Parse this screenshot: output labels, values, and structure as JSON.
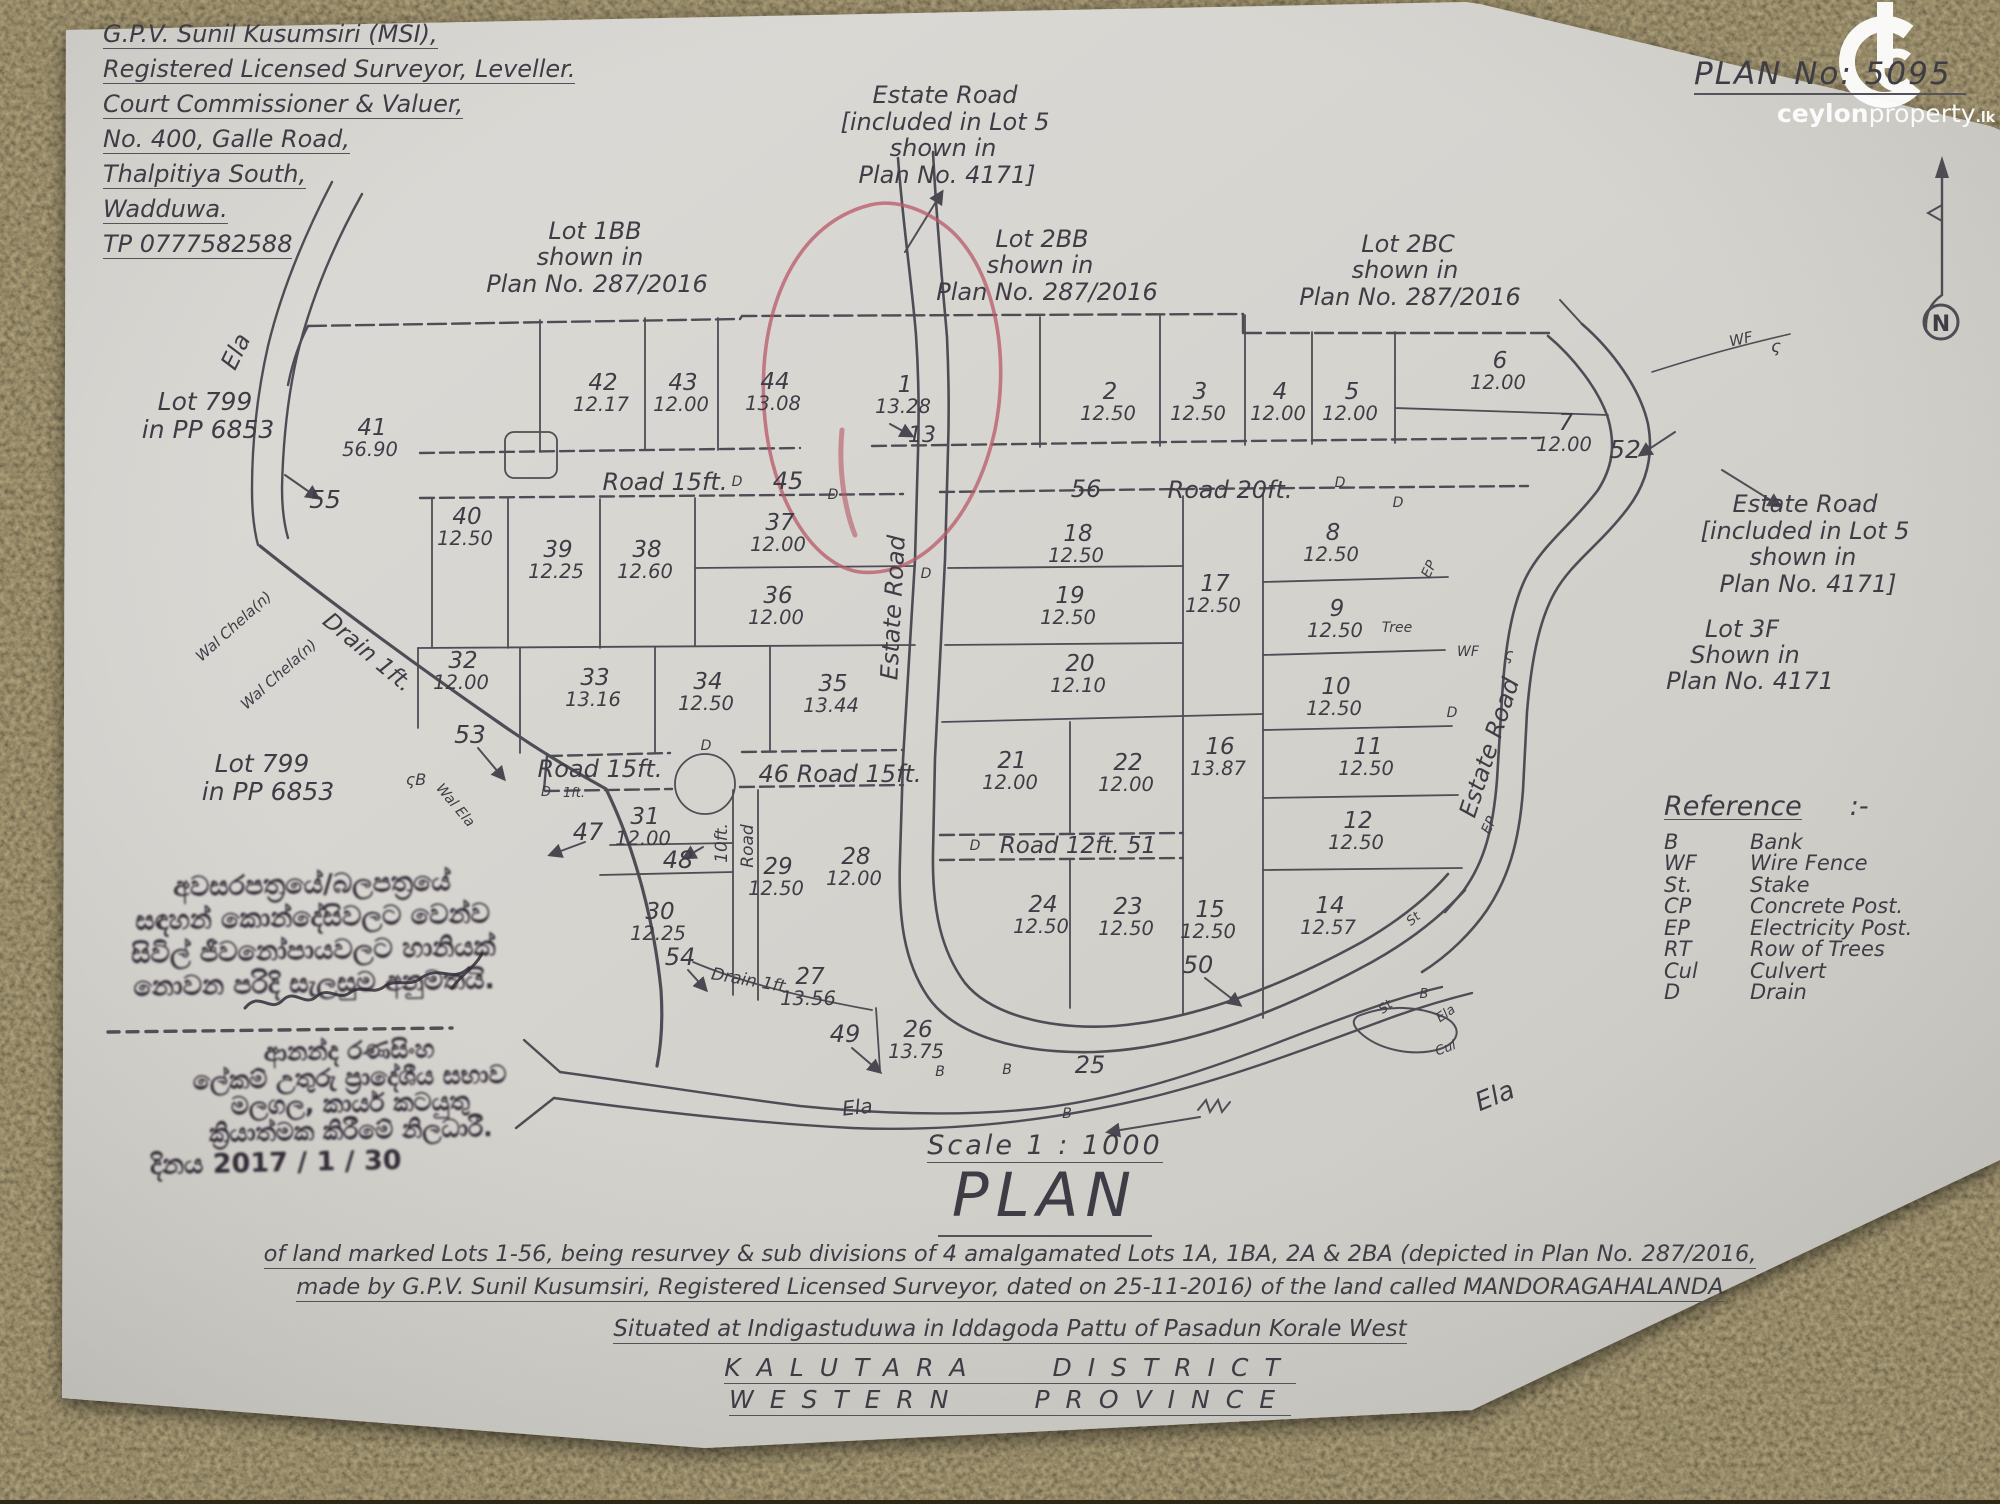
{
  "watermark": {
    "brand_main": "ceylon",
    "brand_sub": "property",
    "brand_tld": ".lk"
  },
  "plan_no": "PLAN No: 5095",
  "north_label": "N",
  "surveyor": {
    "lines": [
      "G.P.V. Sunil Kusumsiri (MSI),",
      "Registered Licensed Surveyor, Leveller.",
      "Court Commissioner & Valuer,",
      "No. 400, Galle Road,",
      "Thalpitiya South,",
      "Wadduwa.",
      "TP 0777582588"
    ]
  },
  "map": {
    "lots": [
      {
        "n": "41",
        "a": "56.90",
        "x": 372,
        "y": 435
      },
      {
        "n": "42",
        "a": "12.17",
        "x": 603,
        "y": 390
      },
      {
        "n": "43",
        "a": "12.00",
        "x": 683,
        "y": 390
      },
      {
        "n": "44",
        "a": "13.08",
        "x": 775,
        "y": 389
      },
      {
        "n": "1",
        "a": "13.28",
        "x": 905,
        "y": 392
      },
      {
        "n": "2",
        "a": "12.50",
        "x": 1110,
        "y": 399
      },
      {
        "n": "3",
        "a": "12.50",
        "x": 1200,
        "y": 399
      },
      {
        "n": "4",
        "a": "12.00",
        "x": 1280,
        "y": 399
      },
      {
        "n": "5",
        "a": "12.00",
        "x": 1352,
        "y": 399
      },
      {
        "n": "6",
        "a": "12.00",
        "x": 1500,
        "y": 368
      },
      {
        "n": "7",
        "a": "12.00",
        "x": 1566,
        "y": 430
      },
      {
        "n": "8",
        "a": "12.50",
        "x": 1333,
        "y": 540
      },
      {
        "n": "9",
        "a": "12.50",
        "x": 1337,
        "y": 616
      },
      {
        "n": "10",
        "a": "12.50",
        "x": 1336,
        "y": 694
      },
      {
        "n": "11",
        "a": "12.50",
        "x": 1368,
        "y": 754
      },
      {
        "n": "12",
        "a": "12.50",
        "x": 1358,
        "y": 828
      },
      {
        "n": "14",
        "a": "12.57",
        "x": 1330,
        "y": 913
      },
      {
        "n": "15",
        "a": "12.50",
        "x": 1210,
        "y": 917
      },
      {
        "n": "16",
        "a": "13.87",
        "x": 1220,
        "y": 754
      },
      {
        "n": "17",
        "a": "12.50",
        "x": 1215,
        "y": 591
      },
      {
        "n": "18",
        "a": "12.50",
        "x": 1078,
        "y": 541
      },
      {
        "n": "19",
        "a": "12.50",
        "x": 1070,
        "y": 603
      },
      {
        "n": "20",
        "a": "12.10",
        "x": 1080,
        "y": 671
      },
      {
        "n": "21",
        "a": "12.00",
        "x": 1012,
        "y": 768
      },
      {
        "n": "22",
        "a": "12.00",
        "x": 1128,
        "y": 770
      },
      {
        "n": "23",
        "a": "12.50",
        "x": 1128,
        "y": 914
      },
      {
        "n": "24",
        "a": "12.50",
        "x": 1043,
        "y": 912
      },
      {
        "n": "26",
        "a": "13.75",
        "x": 918,
        "y": 1037
      },
      {
        "n": "27",
        "a": "13.56",
        "x": 810,
        "y": 984
      },
      {
        "n": "28",
        "a": "12.00",
        "x": 856,
        "y": 864
      },
      {
        "n": "29",
        "a": "12.50",
        "x": 778,
        "y": 874
      },
      {
        "n": "30",
        "a": "12.25",
        "x": 660,
        "y": 919
      },
      {
        "n": "31",
        "a": "12.00",
        "x": 645,
        "y": 824
      },
      {
        "n": "32",
        "a": "12.00",
        "x": 463,
        "y": 668
      },
      {
        "n": "33",
        "a": "13.16",
        "x": 595,
        "y": 685
      },
      {
        "n": "34",
        "a": "12.50",
        "x": 708,
        "y": 689
      },
      {
        "n": "35",
        "a": "13.44",
        "x": 833,
        "y": 691
      },
      {
        "n": "36",
        "a": "12.00",
        "x": 778,
        "y": 603
      },
      {
        "n": "37",
        "a": "12.00",
        "x": 780,
        "y": 530
      },
      {
        "n": "38",
        "a": "12.60",
        "x": 647,
        "y": 557
      },
      {
        "n": "39",
        "a": "12.25",
        "x": 558,
        "y": 557
      },
      {
        "n": "40",
        "a": "12.50",
        "x": 467,
        "y": 524
      }
    ],
    "labels": [
      {
        "t": "Estate Road",
        "x": 945,
        "y": 103,
        "s": 24
      },
      {
        "t": "[included in Lot 5",
        "x": 945,
        "y": 130,
        "s": 24
      },
      {
        "t": "shown in",
        "x": 943,
        "y": 156,
        "s": 24
      },
      {
        "t": "Plan No. 4171]",
        "x": 947,
        "y": 183,
        "s": 24
      },
      {
        "t": "Lot 1BB",
        "x": 595,
        "y": 239,
        "s": 24
      },
      {
        "t": "shown in",
        "x": 590,
        "y": 265,
        "s": 24
      },
      {
        "t": "Plan No. 287/2016",
        "x": 597,
        "y": 292,
        "s": 24
      },
      {
        "t": "Lot 2BB",
        "x": 1042,
        "y": 247,
        "s": 24
      },
      {
        "t": "shown in",
        "x": 1040,
        "y": 273,
        "s": 24
      },
      {
        "t": "Plan No. 287/2016",
        "x": 1047,
        "y": 300,
        "s": 24
      },
      {
        "t": "Lot 2BC",
        "x": 1408,
        "y": 252,
        "s": 24
      },
      {
        "t": "shown in",
        "x": 1405,
        "y": 278,
        "s": 24
      },
      {
        "t": "Plan No. 287/2016",
        "x": 1410,
        "y": 305,
        "s": 24
      },
      {
        "t": "Lot 799",
        "x": 205,
        "y": 410,
        "s": 25
      },
      {
        "t": "in PP 6853",
        "x": 208,
        "y": 438,
        "s": 25
      },
      {
        "t": "Lot 799",
        "x": 262,
        "y": 772,
        "s": 25
      },
      {
        "t": "in PP 6853",
        "x": 268,
        "y": 800,
        "s": 25
      },
      {
        "t": "Estate Road",
        "x": 1805,
        "y": 512,
        "s": 24
      },
      {
        "t": "[included in Lot 5",
        "x": 1805,
        "y": 539,
        "s": 24
      },
      {
        "t": "shown in",
        "x": 1803,
        "y": 565,
        "s": 24
      },
      {
        "t": "Plan No. 4171]",
        "x": 1808,
        "y": 592,
        "s": 24
      },
      {
        "t": "Lot 3F",
        "x": 1742,
        "y": 637,
        "s": 24
      },
      {
        "t": "Shown in",
        "x": 1745,
        "y": 663,
        "s": 24
      },
      {
        "t": "Plan No. 4171",
        "x": 1750,
        "y": 689,
        "s": 24
      },
      {
        "t": "Road 15ft.",
        "x": 665,
        "y": 490,
        "s": 24
      },
      {
        "t": "45",
        "x": 788,
        "y": 489,
        "s": 24
      },
      {
        "t": "56",
        "x": 1086,
        "y": 497,
        "s": 24
      },
      {
        "t": "Road 20ft.",
        "x": 1230,
        "y": 498,
        "s": 24
      },
      {
        "t": "Road 15ft.",
        "x": 600,
        "y": 777,
        "s": 24
      },
      {
        "t": "46 Road 15ft.",
        "x": 840,
        "y": 782,
        "s": 24
      },
      {
        "t": "Road 12ft. 51",
        "x": 1078,
        "y": 853,
        "s": 23
      },
      {
        "t": "10ft.",
        "x": 727,
        "y": 843,
        "s": 17,
        "r": -90
      },
      {
        "t": "Road",
        "x": 753,
        "y": 846,
        "s": 17,
        "r": -90
      },
      {
        "t": "Estate Road",
        "x": 901,
        "y": 608,
        "s": 24,
        "r": -87
      },
      {
        "t": "Estate Road",
        "x": 1497,
        "y": 750,
        "s": 24,
        "r": -72
      },
      {
        "t": "Ela",
        "x": 243,
        "y": 355,
        "s": 24,
        "r": -64
      },
      {
        "t": "Ela",
        "x": 858,
        "y": 1114,
        "s": 20,
        "r": -6
      },
      {
        "t": "Ela",
        "x": 1498,
        "y": 1104,
        "s": 26,
        "r": -22
      },
      {
        "t": "Drain 1ft.",
        "x": 363,
        "y": 658,
        "s": 23,
        "r": 40
      },
      {
        "t": "Drain 1ft.",
        "x": 750,
        "y": 986,
        "s": 17,
        "r": 10
      },
      {
        "t": "Wal Chela(n)",
        "x": 237,
        "y": 630,
        "s": 15,
        "r": -42
      },
      {
        "t": "Wal Chela(n)",
        "x": 282,
        "y": 678,
        "s": 15,
        "r": -42
      },
      {
        "t": "Wal Ela",
        "x": 452,
        "y": 808,
        "s": 14,
        "r": 50
      },
      {
        "t": "55",
        "x": 325,
        "y": 508,
        "s": 25
      },
      {
        "t": "53",
        "x": 470,
        "y": 743,
        "s": 25
      },
      {
        "t": "47",
        "x": 588,
        "y": 840,
        "s": 24
      },
      {
        "t": "48",
        "x": 678,
        "y": 868,
        "s": 24
      },
      {
        "t": "54",
        "x": 680,
        "y": 965,
        "s": 24
      },
      {
        "t": "49",
        "x": 845,
        "y": 1042,
        "s": 24
      },
      {
        "t": "50",
        "x": 1198,
        "y": 973,
        "s": 24
      },
      {
        "t": "25",
        "x": 1090,
        "y": 1073,
        "s": 24
      },
      {
        "t": "52",
        "x": 1625,
        "y": 458,
        "s": 25
      },
      {
        "t": "13",
        "x": 922,
        "y": 442,
        "s": 22
      },
      {
        "t": "D",
        "x": 737,
        "y": 486,
        "s": 14
      },
      {
        "t": "D",
        "x": 833,
        "y": 499,
        "s": 14
      },
      {
        "t": "D",
        "x": 1340,
        "y": 487,
        "s": 14
      },
      {
        "t": "D",
        "x": 1398,
        "y": 507,
        "s": 14
      },
      {
        "t": "D",
        "x": 926,
        "y": 578,
        "s": 14
      },
      {
        "t": "D",
        "x": 706,
        "y": 750,
        "s": 14
      },
      {
        "t": "D",
        "x": 975,
        "y": 850,
        "s": 14
      },
      {
        "t": "D",
        "x": 546,
        "y": 796,
        "s": 13
      },
      {
        "t": "1ft.",
        "x": 574,
        "y": 797,
        "s": 13
      },
      {
        "t": "D",
        "x": 1452,
        "y": 717,
        "s": 14
      },
      {
        "t": "B",
        "x": 1007,
        "y": 1074,
        "s": 14
      },
      {
        "t": "B",
        "x": 1067,
        "y": 1118,
        "s": 14
      },
      {
        "t": "B",
        "x": 940,
        "y": 1076,
        "s": 14
      },
      {
        "t": "B",
        "x": 1424,
        "y": 998,
        "s": 13
      },
      {
        "t": "Ela",
        "x": 1448,
        "y": 1017,
        "s": 13,
        "r": -35
      },
      {
        "t": "Cul",
        "x": 1447,
        "y": 1052,
        "s": 13,
        "r": -20
      },
      {
        "t": "St",
        "x": 1388,
        "y": 1010,
        "s": 13,
        "r": -38
      },
      {
        "t": "St",
        "x": 1416,
        "y": 922,
        "s": 13,
        "r": -40
      },
      {
        "t": "Tree",
        "x": 1397,
        "y": 632,
        "s": 14
      },
      {
        "t": "WF",
        "x": 1742,
        "y": 344,
        "s": 15,
        "r": -12
      },
      {
        "t": "ς",
        "x": 1776,
        "y": 352,
        "s": 17
      },
      {
        "t": "WF",
        "x": 1468,
        "y": 656,
        "s": 14
      },
      {
        "t": "ς",
        "x": 1509,
        "y": 660,
        "s": 16
      },
      {
        "t": "EP",
        "x": 1433,
        "y": 571,
        "s": 14,
        "r": -65
      },
      {
        "t": "EP",
        "x": 1493,
        "y": 827,
        "s": 14,
        "r": -65
      },
      {
        "t": "ςB",
        "x": 416,
        "y": 785,
        "s": 16
      }
    ]
  },
  "reference": {
    "title": "Reference",
    "punct": ":-",
    "items": [
      {
        "abbr": "B",
        "term": "Bank"
      },
      {
        "abbr": "WF",
        "term": "Wire Fence"
      },
      {
        "abbr": "St.",
        "term": "Stake"
      },
      {
        "abbr": "CP",
        "term": "Concrete Post."
      },
      {
        "abbr": "EP",
        "term": "Electricity Post."
      },
      {
        "abbr": "RT",
        "term": "Row of Trees"
      },
      {
        "abbr": "Cul",
        "term": "Culvert"
      },
      {
        "abbr": "D",
        "term": "Drain"
      }
    ]
  },
  "stamp": {
    "approval_lines": [
      "අවසරපත්‍රයේ/බලපත්‍රයේ",
      "සඳහන් කොන්දේසිවලට වෙන්ව",
      "සිවිල් ජීවනෝපායවලට හානියක්",
      "නොවන පරිදි සැලසුම අනුමතයි."
    ],
    "officer_lines": [
      "ආනන්ද රණසිංහ",
      "ලේකම් උතුරු ප්‍රාදේශීය සභාව",
      "මලගල, කාර්ය කටයුතු",
      "ක්‍රියාත්මක කිරීමේ නිලධාරී."
    ],
    "date_line": "දිනය  2017 / 1 / 30"
  },
  "scale_text": "Scale  1 : 1000",
  "main_title": "PLAN",
  "description": {
    "line1": "of land marked Lots 1-56, being resurvey & sub divisions of 4 amalgamated Lots 1A, 1BA, 2A & 2BA (depicted in Plan No. 287/2016,",
    "line2": "made by G.P.V. Sunil Kusumsiri, Registered Licensed Surveyor, dated on 25-11-2016)  of the land called MANDORAGAHALANDA",
    "line3": "Situated at Indigastuduwa in Iddagoda Pattu of Pasadun Korale West",
    "district": "KALUTARA DISTRICT",
    "province": "WESTERN PROVINCE"
  }
}
